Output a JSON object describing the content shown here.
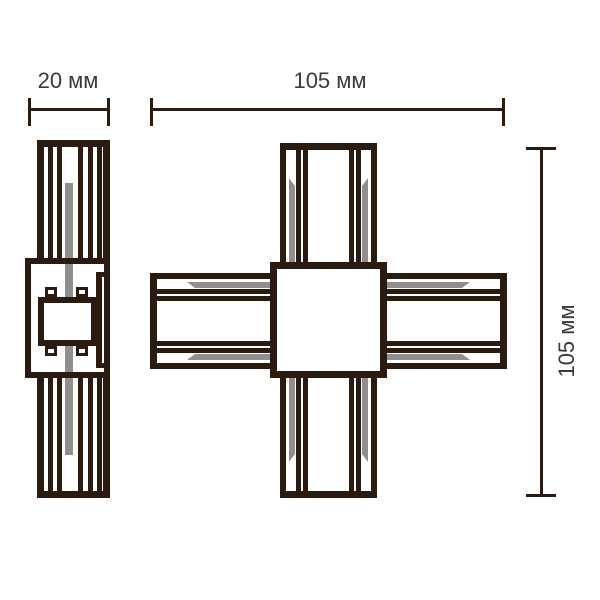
{
  "labels": {
    "side_width": "20 мм",
    "front_width": "105 мм",
    "front_height": "105 мм"
  },
  "colors": {
    "line": "#2a1a0f",
    "gray": "#8f8f8f",
    "text": "#3a3a3a",
    "background": "#ffffff"
  }
}
